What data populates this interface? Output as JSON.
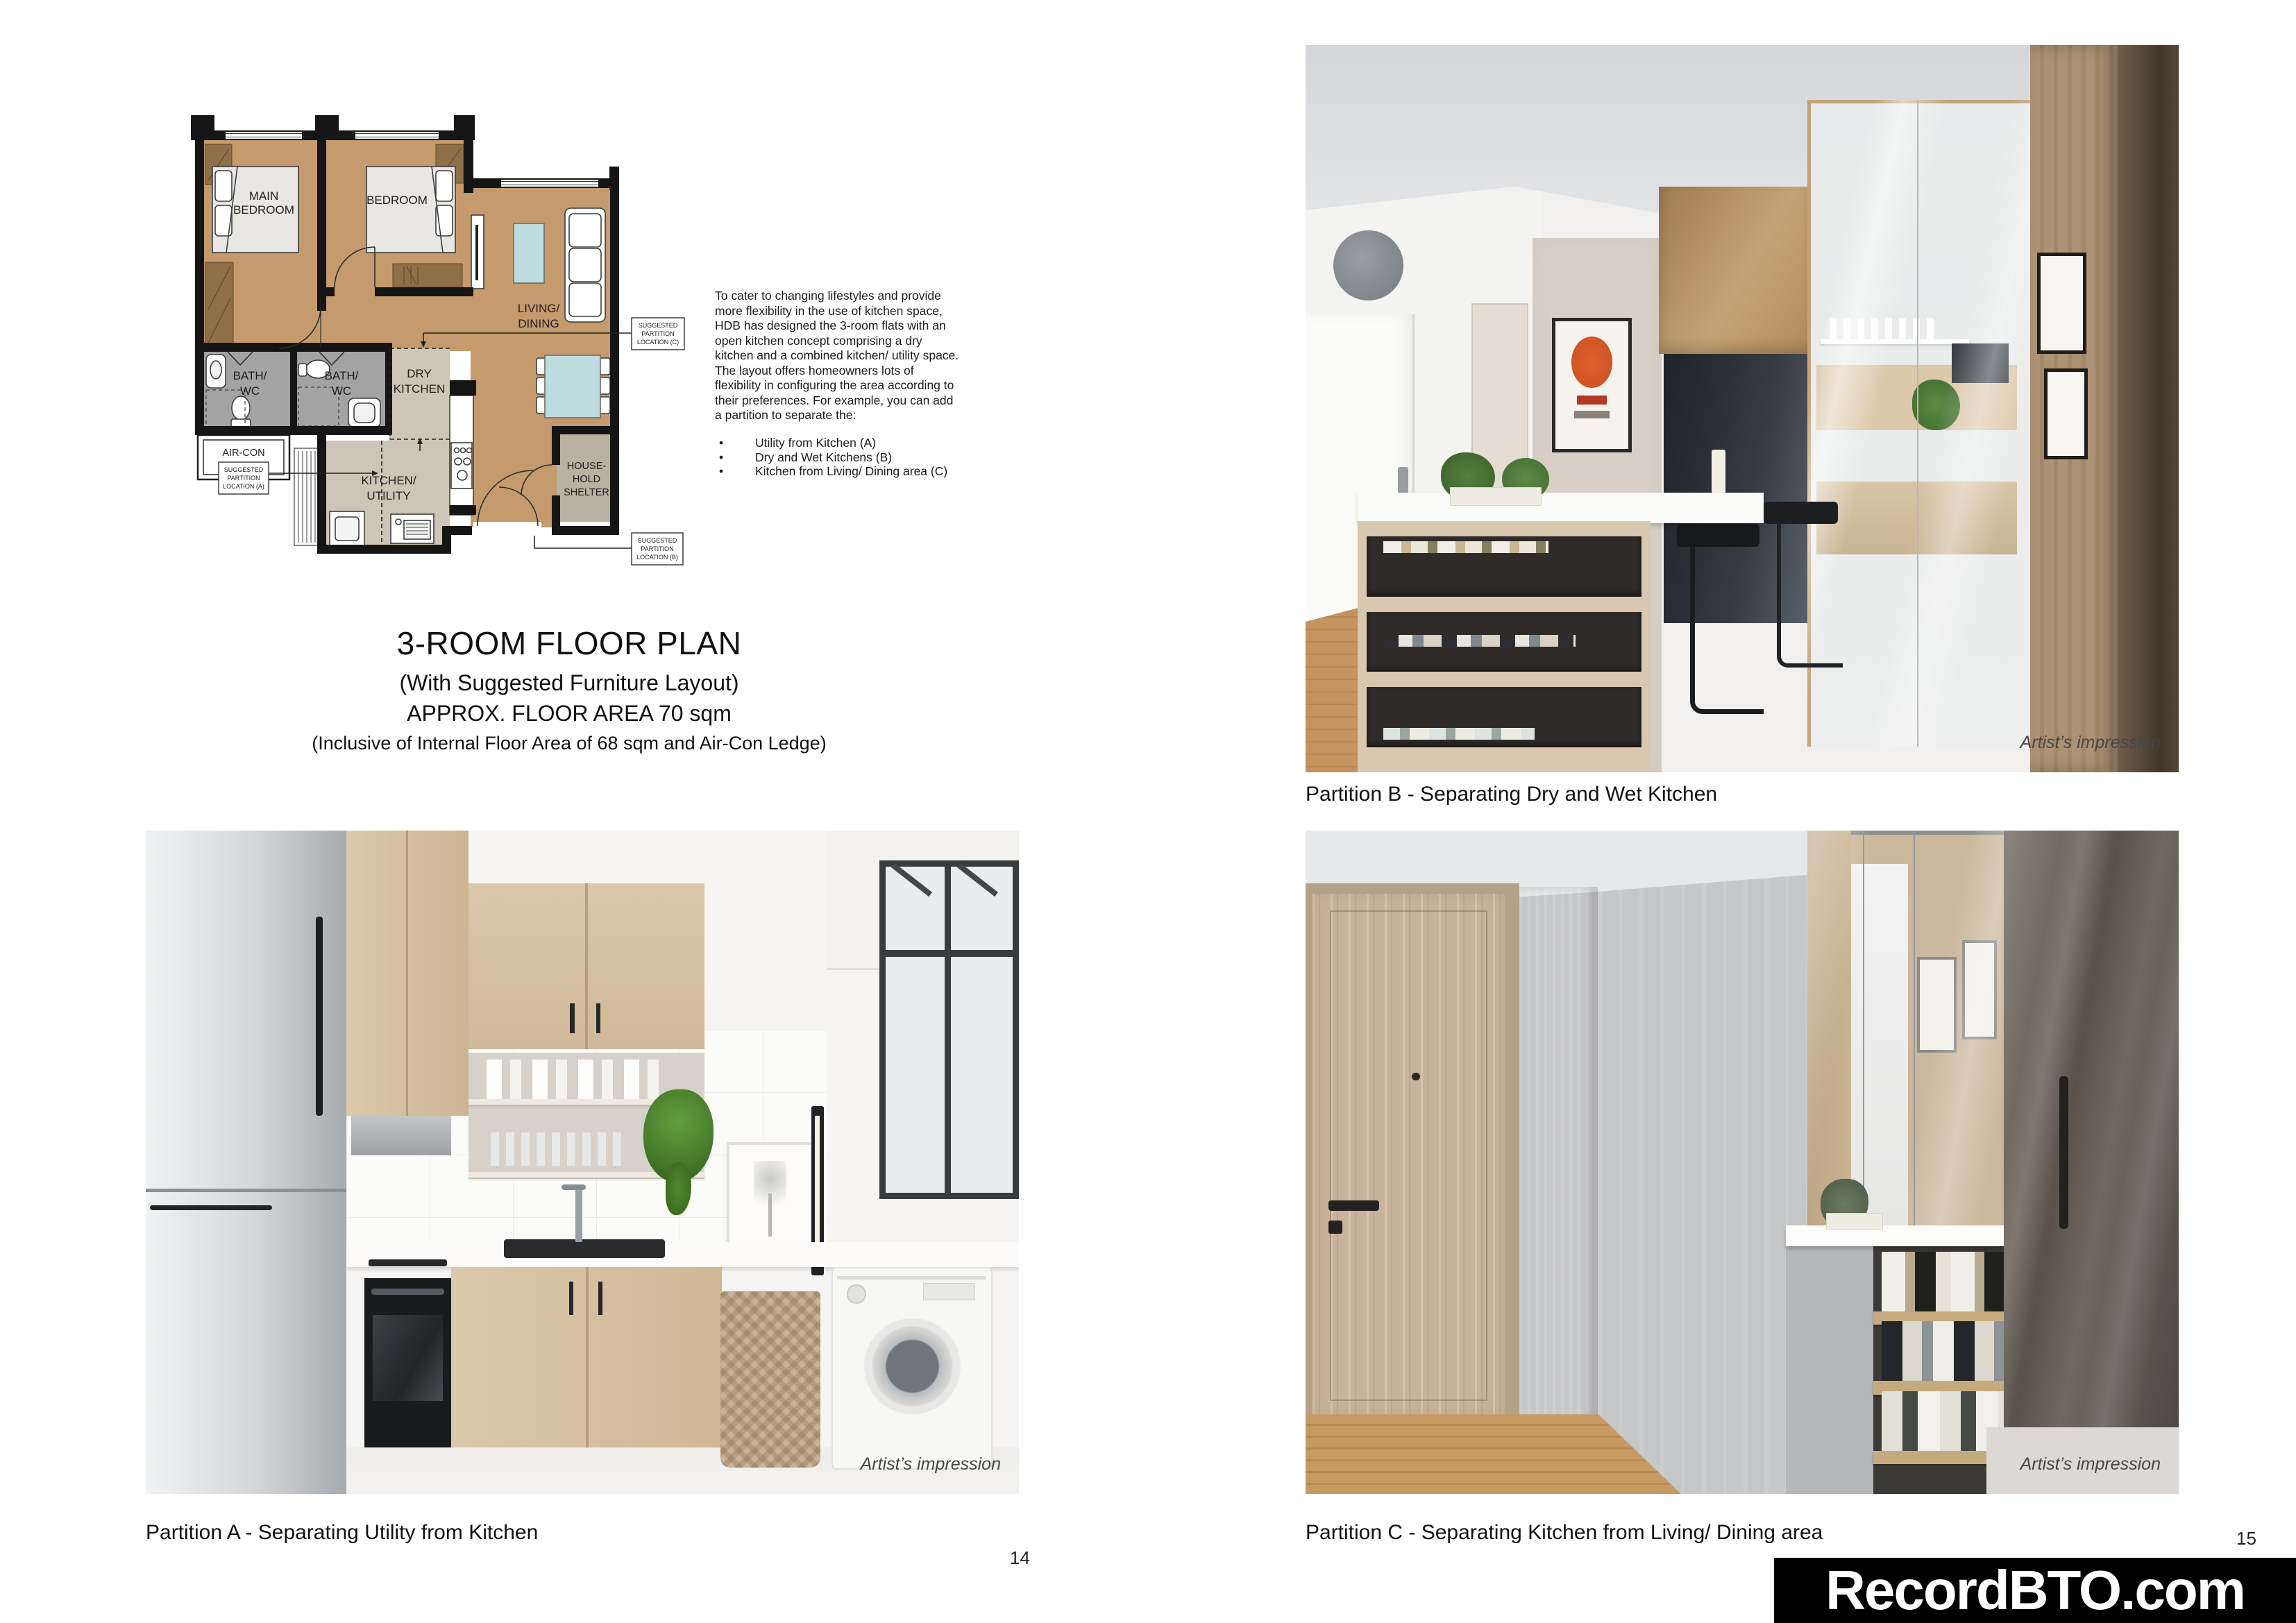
{
  "page": {
    "page_numbers": {
      "left": "14",
      "right": "15"
    },
    "watermark": {
      "text": "RecordBTO.com",
      "bg": "#000000",
      "fg": "#ffffff"
    }
  },
  "intro": {
    "paragraph": "To cater to changing lifestyles and provide more flexibility in the use of kitchen space, HDB has designed the 3-room flats with an open kitchen concept comprising a dry kitchen and a combined kitchen/ utility space. The layout offers homeowners lots of flexibility in configuring the area according to their preferences. For example, you can add a partition to separate the:",
    "bullets": [
      "Utility from Kitchen (A)",
      "Dry and Wet Kitchens (B)",
      "Kitchen from Living/ Dining area (C)"
    ]
  },
  "title_block": {
    "line1": "3-ROOM FLOOR PLAN",
    "line2": "(With Suggested Furniture Layout)",
    "line3": "APPROX. FLOOR AREA 70 sqm",
    "line4": "(Inclusive of Internal Floor Area of 68 sqm and Air-Con Ledge)"
  },
  "floor_plan": {
    "colors": {
      "room_brown": "#c59a6d",
      "wardrobe_brown": "#8f6f48",
      "bath_grey": "#a3a3a3",
      "kitchen_beige": "#cdc5b5",
      "shelter_beige": "#b9b1a2",
      "table_blue": "#bcdce0",
      "wall_black": "#151515"
    },
    "labels": {
      "main_bedroom": [
        "MAIN",
        "BEDROOM"
      ],
      "bedroom": "BEDROOM",
      "living_dining": [
        "LIVING/",
        "DINING"
      ],
      "bath": [
        "BATH/",
        "WC"
      ],
      "dry_kitchen": [
        "DRY",
        "KITCHEN"
      ],
      "aircon_ledge": [
        "AIR-CON",
        "LEDGE"
      ],
      "kitchen_utility": [
        "KITCHEN/",
        "UTILITY"
      ],
      "household_shelter": [
        "HOUSE-",
        "HOLD",
        "SHELTER"
      ]
    },
    "partition_tags": {
      "a": [
        "SUGGESTED",
        "PARTITION",
        "LOCATION (A)"
      ],
      "b": [
        "SUGGESTED",
        "PARTITION",
        "LOCATION (B)"
      ],
      "c": [
        "SUGGESTED",
        "PARTITION",
        "LOCATION (C)"
      ]
    }
  },
  "photos": {
    "partition_a": {
      "caption": "Partition A - Separating Utility from Kitchen",
      "credit": "Artist’s impression"
    },
    "partition_b": {
      "caption": "Partition B - Separating Dry and Wet Kitchen",
      "credit": "Artist’s impression"
    },
    "partition_c": {
      "caption": "Partition C - Separating Kitchen from Living/ Dining area",
      "credit": "Artist’s impression"
    }
  }
}
